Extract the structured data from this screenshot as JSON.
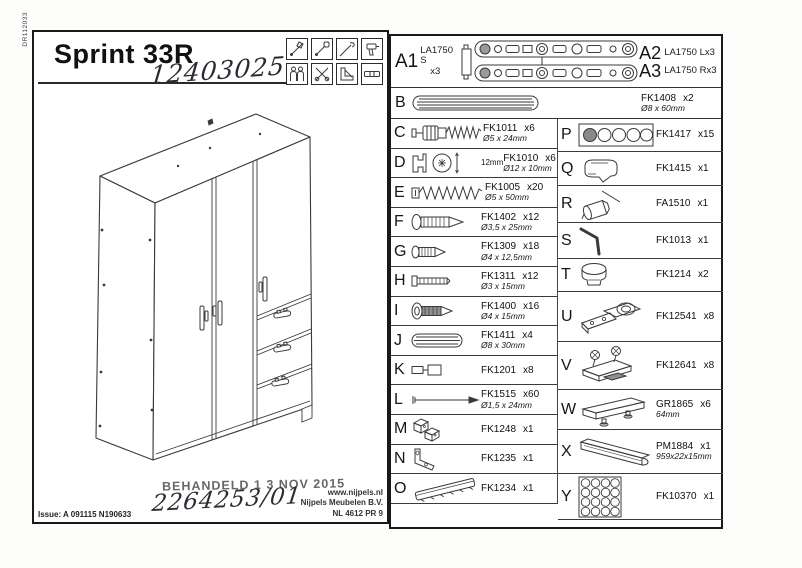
{
  "ink_color": "#1c1c1c",
  "doc_code": "DR112033",
  "header": {
    "title": "Sprint 33R",
    "handwritten_number": "12403025",
    "tool_icons": [
      "hammer",
      "screwdriver",
      "awl",
      "drill",
      "two-person",
      "pliers",
      "try-square",
      "spirit-level"
    ]
  },
  "drawing": {
    "subject": "three-door wardrobe with three drawers, perspective line drawing"
  },
  "footer": {
    "stamp": "BEHANDELD 1 3 NOV 2015",
    "handwritten_order": "2264253/01",
    "issue": "Issue: A 091115 N190633",
    "website": "www.nijpels.nl",
    "company": "Nijpels Meubelen B.V.",
    "company_code": "NL 4612 PR 9"
  },
  "parts": {
    "rowA": {
      "id1": "A1",
      "code1": "LA1750 S",
      "qty1": "x3",
      "id2": "A2",
      "code2": "LA1750 Lx3",
      "id3": "A3",
      "code3": "LA1750 Rx3"
    },
    "rowB": {
      "id": "B",
      "code": "FK1408",
      "qty": "x2",
      "dim": "Ø8 x 60mm"
    },
    "left": [
      {
        "id": "C",
        "code": "FK1011",
        "qty": "x6",
        "dim": "Ø5 x 24mm",
        "icon": "cam-bolt"
      },
      {
        "id": "D",
        "code": "FK1010",
        "qty": "x6",
        "dim": "Ø12 x 10mm",
        "icon": "cam-lock",
        "note": "12mm"
      },
      {
        "id": "E",
        "code": "FK1005",
        "qty": "x20",
        "dim": "Ø5 x 50mm",
        "icon": "long-screw"
      },
      {
        "id": "F",
        "code": "FK1402",
        "qty": "x12",
        "dim": "Ø3,5 x 25mm",
        "icon": "screw"
      },
      {
        "id": "G",
        "code": "FK1309",
        "qty": "x18",
        "dim": "Ø4 x 12,5mm",
        "icon": "short-screw"
      },
      {
        "id": "H",
        "code": "FK1311",
        "qty": "x12",
        "dim": "Ø3 x 15mm",
        "icon": "straight-screw"
      },
      {
        "id": "I",
        "code": "FK1400",
        "qty": "x16",
        "dim": "Ø4 x 15mm",
        "icon": "washer-screw"
      },
      {
        "id": "J",
        "code": "FK1411",
        "qty": "x4",
        "dim": "Ø8 x 30mm",
        "icon": "dowel"
      },
      {
        "id": "K",
        "code": "FK1201",
        "qty": "x8",
        "icon": "connector"
      },
      {
        "id": "L",
        "code": "FK1515",
        "qty": "x60",
        "dim": "Ø1,5 x 24mm",
        "icon": "nail"
      },
      {
        "id": "M",
        "code": "FK1248",
        "qty": "x1",
        "icon": "plastic-blocks"
      },
      {
        "id": "N",
        "code": "FK1235",
        "qty": "x1",
        "icon": "angle-bracket"
      },
      {
        "id": "O",
        "code": "FK1234",
        "qty": "x1",
        "icon": "toothed-strip"
      }
    ],
    "right": [
      {
        "id": "P",
        "code": "FK1417",
        "qty": "x15",
        "icon": "cover-caps"
      },
      {
        "id": "Q",
        "code": "FK1415",
        "qty": "x1",
        "icon": "plastic-fitting"
      },
      {
        "id": "R",
        "code": "FA1510",
        "qty": "x1",
        "icon": "glue-tube"
      },
      {
        "id": "S",
        "code": "FK1013",
        "qty": "x1",
        "icon": "allen-key"
      },
      {
        "id": "T",
        "code": "FK1214",
        "qty": "x2",
        "icon": "knob"
      },
      {
        "id": "U",
        "code": "FK12541",
        "qty": "x8",
        "icon": "hinge"
      },
      {
        "id": "V",
        "code": "FK12641",
        "qty": "x8",
        "icon": "hinge-plate"
      },
      {
        "id": "W",
        "code": "GR1865",
        "qty": "x6",
        "dim": "64mm",
        "icon": "handle"
      },
      {
        "id": "X",
        "code": "PM1884",
        "qty": "x1",
        "dim": "959x22x15mm",
        "icon": "profile-bar"
      },
      {
        "id": "Y",
        "code": "FK10370",
        "qty": "x1",
        "icon": "sticker-sheet"
      }
    ]
  }
}
